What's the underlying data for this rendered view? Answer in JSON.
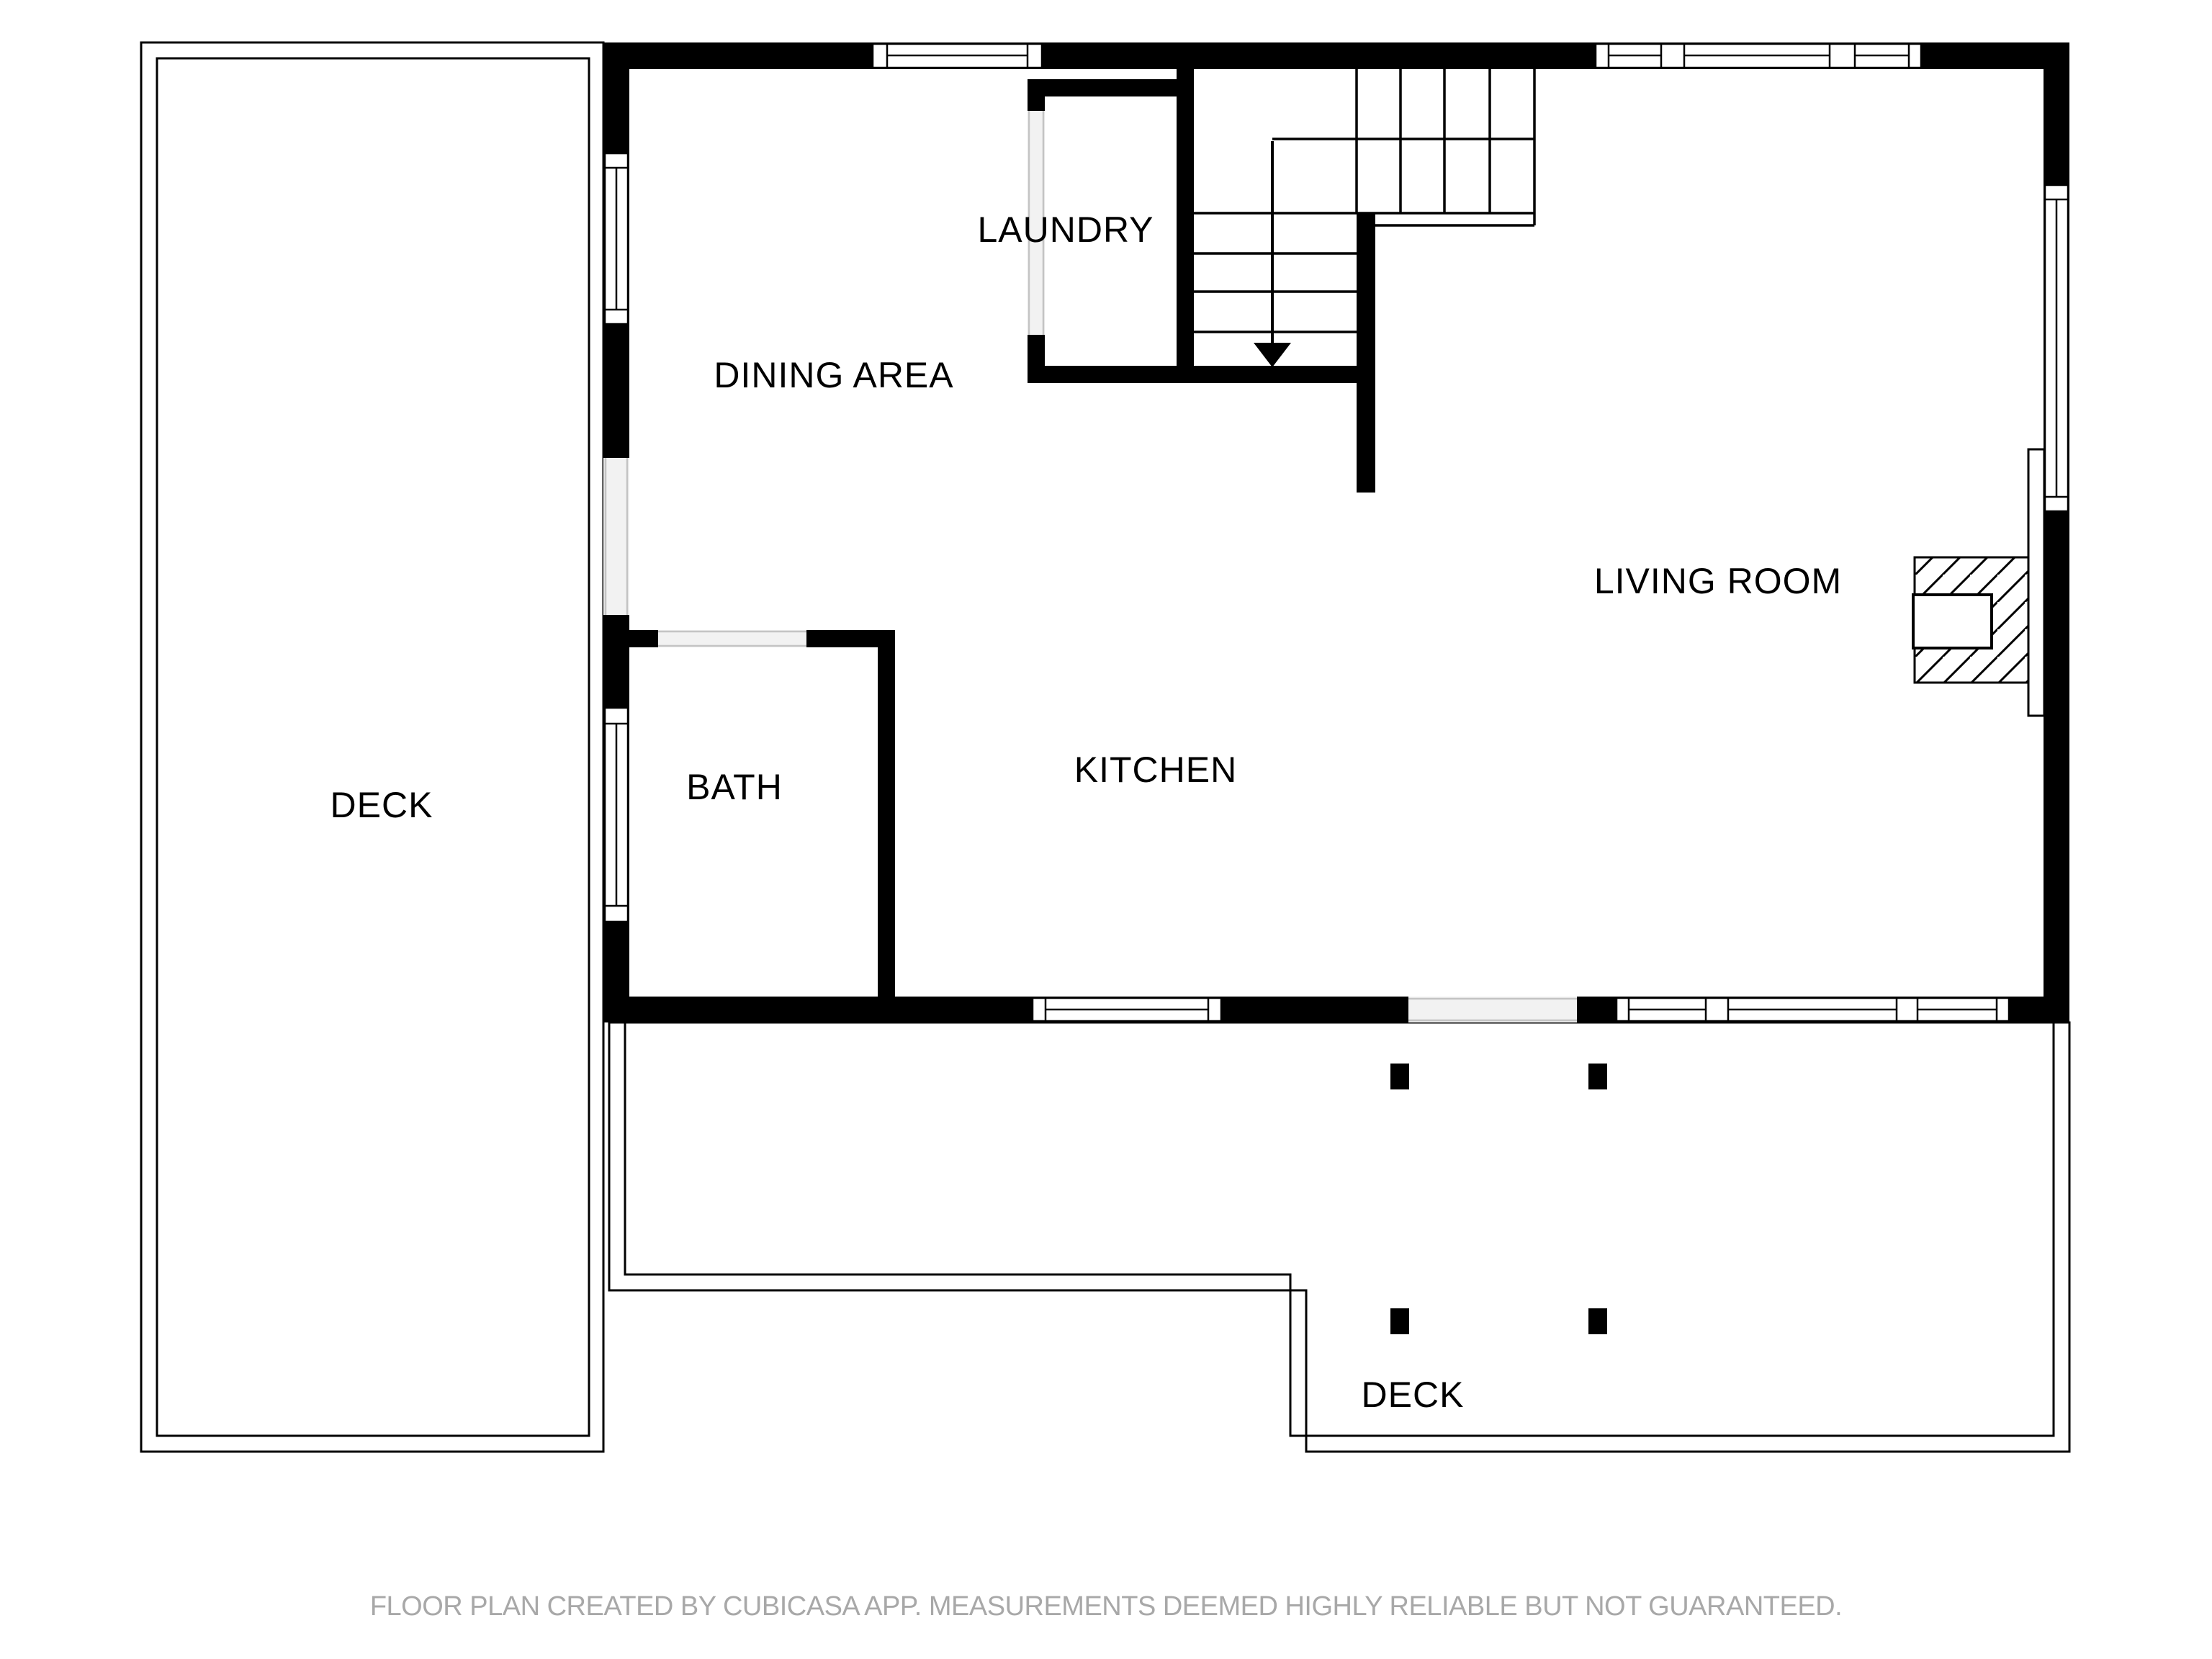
{
  "title": "Floor plan",
  "creator_note": "CubiCasa floor plan drawing",
  "labels": {
    "dining_area": "DINING AREA",
    "laundry": "LAUNDRY",
    "living_room": "LIVING ROOM",
    "kitchen": "KITCHEN",
    "bath": "BATH",
    "deck_left": "DECK",
    "deck_bottom": "DECK"
  },
  "rooms": [
    {
      "name": "DINING AREA"
    },
    {
      "name": "LAUNDRY"
    },
    {
      "name": "LIVING ROOM"
    },
    {
      "name": "KITCHEN"
    },
    {
      "name": "BATH"
    },
    {
      "name": "DECK"
    },
    {
      "name": "DECK"
    }
  ],
  "icons": [
    {
      "name": "stairs-down-arrow-icon",
      "meaning": "stair direction arrow pointing down"
    },
    {
      "name": "fireplace-icon",
      "meaning": "hatched fireplace block with firebox on living room wall"
    },
    {
      "name": "deck-post-icon",
      "meaning": "square deck support posts"
    }
  ],
  "footer": {
    "disclaimer": "FLOOR PLAN CREATED BY CUBICASA APP. MEASUREMENTS DEEMED HIGHLY RELIABLE BUT NOT GUARANTEED."
  },
  "colors": {
    "wall": "#000000",
    "background": "#ffffff",
    "opening_fill": "#f2f2f2",
    "opening_line": "#c4c4c4",
    "footer_text": "#a8a8a8"
  }
}
